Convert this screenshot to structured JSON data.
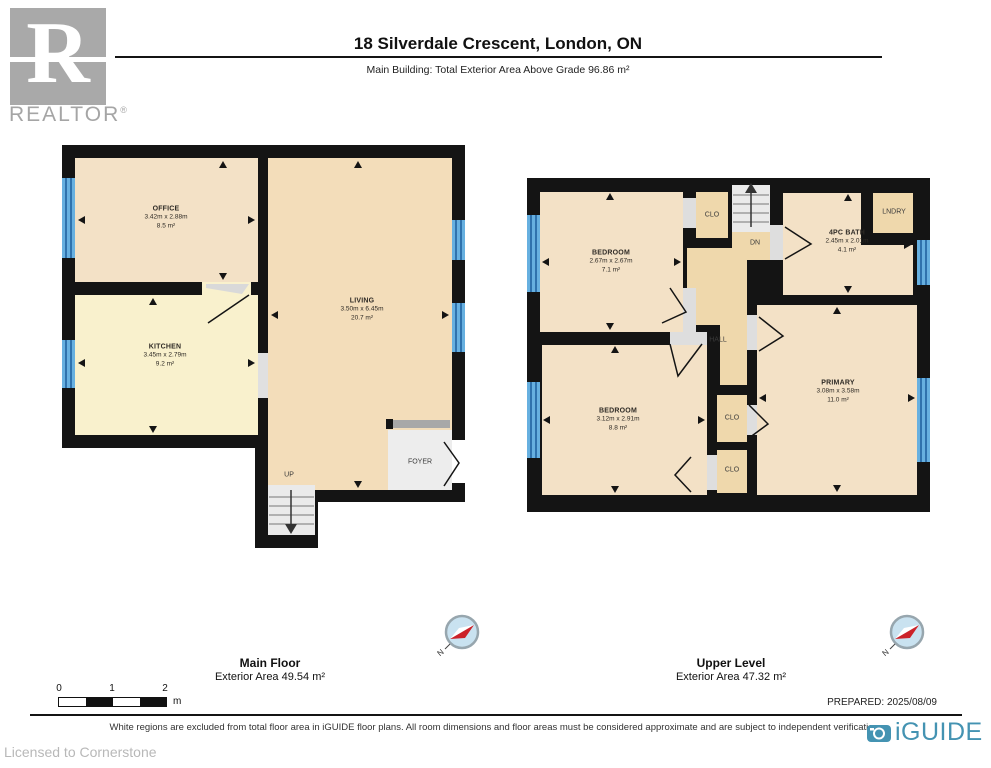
{
  "header": {
    "logo_letter": "R",
    "logo_brand": "REALTOR",
    "logo_reg": "®",
    "title": "18 Silverdale Crescent, London, ON",
    "subtitle": "Main Building: Total Exterior Area Above Grade 96.86 m²"
  },
  "main_floor": {
    "label": "Main Floor",
    "area": "Exterior Area 49.54 m²",
    "office": {
      "name": "OFFICE",
      "dims": "3.42m x 2.88m",
      "area": "8.5 m²"
    },
    "kitchen": {
      "name": "KITCHEN",
      "dims": "3.45m x 2.79m",
      "area": "9.2 m²"
    },
    "living": {
      "name": "LIVING",
      "dims": "3.50m x 6.45m",
      "area": "20.7 m²"
    },
    "foyer": "FOYER",
    "up": "UP"
  },
  "upper_level": {
    "label": "Upper Level",
    "area": "Exterior Area 47.32 m²",
    "bedroom1": {
      "name": "BEDROOM",
      "dims": "2.67m x 2.67m",
      "area": "7.1 m²"
    },
    "bedroom2": {
      "name": "BEDROOM",
      "dims": "3.12m x 2.91m",
      "area": "8.8 m²"
    },
    "bath": {
      "name": "4PC BATH",
      "dims": "2.45m x 2.01m",
      "area": "4.1 m²"
    },
    "primary": {
      "name": "PRIMARY",
      "dims": "3.08m x 3.58m",
      "area": "11.0 m²"
    },
    "clo_top": "CLO",
    "clo_mid": "CLO",
    "clo_bot": "CLO",
    "lndry": "LNDRY",
    "hall": "HALL",
    "dn": "DN"
  },
  "scale_bar": {
    "t0": "0",
    "t1": "1",
    "t2": "2",
    "unit": "m"
  },
  "footer": {
    "prepared": "PREPARED: 2025/08/09",
    "disclaimer": "White regions are excluded from total floor area in iGUIDE floor plans. All room dimensions and floor areas must be considered approximate and are subject to independent verification.",
    "licensed": "Licensed to Cornerstone",
    "iguide": "iGUIDE"
  },
  "compass_n": "N",
  "colors": {
    "wall": "#141414",
    "room_tan": "#f3e1c6",
    "kitchen_cream": "#f9f1cd",
    "living_tan": "#f3ddba",
    "hall_tan": "#efd8ac",
    "window_blue": "#67b0e0",
    "window_stripe": "#1d5d9c",
    "excluded_gray": "#ededed",
    "iguide_teal": "#4493b2",
    "compass_red": "#cc2229"
  }
}
